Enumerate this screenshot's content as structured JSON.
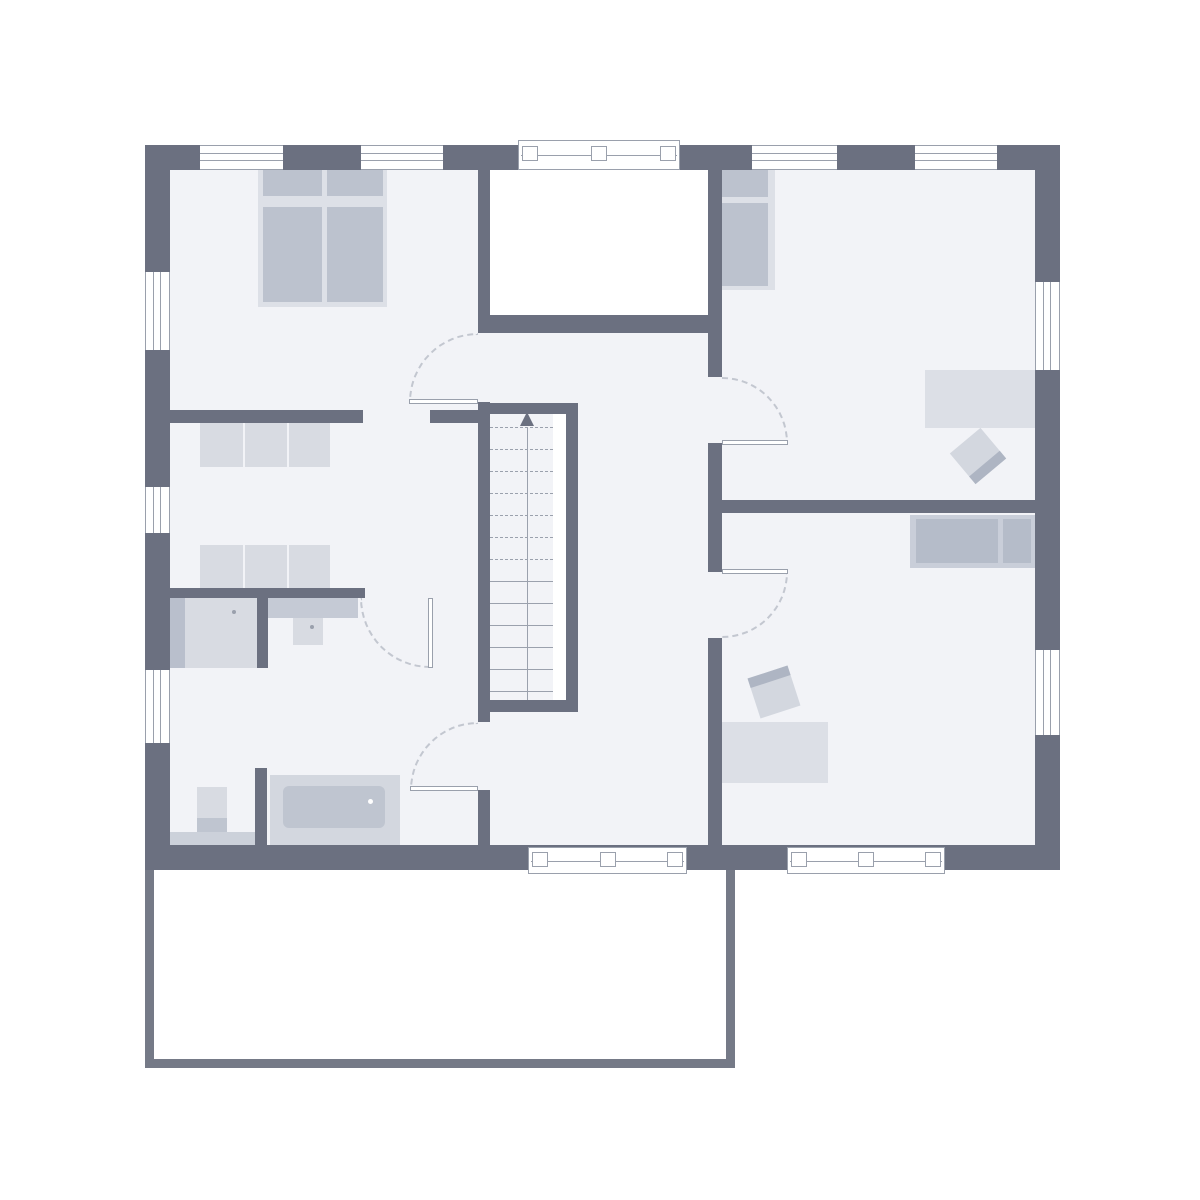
{
  "title": "residential-upper-floor-plan",
  "canvas": {
    "width": 1200,
    "height": 1200
  },
  "colors": {
    "wall": "#6b7080",
    "floor": "#f2f3f7",
    "frame": "#9aa0ac",
    "arc": "#c3c7d0",
    "tread": "#9ba1ad",
    "balcony": "#757a87",
    "furniture_light": "#dde0e7",
    "furniture_mid": "#bcc2ce",
    "white": "#ffffff"
  },
  "rooms": [
    {
      "name": "room-bedroom",
      "x": 170,
      "y": 170,
      "w": 308,
      "h": 240
    },
    {
      "name": "room-dressing",
      "x": 170,
      "y": 423,
      "w": 308,
      "h": 165
    },
    {
      "name": "room-bathroom",
      "x": 170,
      "y": 598,
      "w": 308,
      "h": 247
    },
    {
      "name": "room-hallway",
      "x": 490,
      "y": 333,
      "w": 218,
      "h": 512
    },
    {
      "name": "room-staircase",
      "x": 490,
      "y": 403,
      "w": 88,
      "h": 309
    },
    {
      "name": "room-void",
      "x": 490,
      "y": 170,
      "w": 218,
      "h": 145
    },
    {
      "name": "room-child-1",
      "x": 722,
      "y": 170,
      "w": 313,
      "h": 330
    },
    {
      "name": "room-child-2",
      "x": 722,
      "y": 513,
      "w": 313,
      "h": 332
    },
    {
      "name": "room-balcony",
      "x": 154,
      "y": 870,
      "w": 572,
      "h": 189
    }
  ],
  "elements": [
    {
      "name": "floor-area",
      "type": "fill",
      "x": 170,
      "y": 170,
      "w": 865,
      "h": 675
    },
    {
      "name": "void-open-space",
      "type": "voidarea",
      "x": 490,
      "y": 170,
      "w": 218,
      "h": 145
    },
    {
      "name": "stair-side-gap",
      "type": "voidarea",
      "x": 553,
      "y": 414,
      "w": 13,
      "h": 286
    },
    {
      "name": "double-bed-frame",
      "type": "furn",
      "x": 258,
      "y": 165,
      "w": 129,
      "h": 142,
      "color": "#dde0e7"
    },
    {
      "name": "double-bed-pillow-left",
      "type": "furn",
      "x": 263,
      "y": 169,
      "w": 59,
      "h": 27,
      "color": "#bcc2ce"
    },
    {
      "name": "double-bed-pillow-right",
      "type": "furn",
      "x": 327,
      "y": 169,
      "w": 56,
      "h": 27,
      "color": "#bcc2ce"
    },
    {
      "name": "double-bed-mattress-left",
      "type": "furn",
      "x": 263,
      "y": 207,
      "w": 59,
      "h": 95,
      "color": "#bcc2ce"
    },
    {
      "name": "double-bed-mattress-right",
      "type": "furn",
      "x": 327,
      "y": 207,
      "w": 56,
      "h": 95,
      "color": "#bcc2ce"
    },
    {
      "name": "wardrobe-row-1",
      "type": "furn",
      "x": 200,
      "y": 423,
      "w": 130,
      "h": 44,
      "color": "#d8dbe2"
    },
    {
      "name": "wardrobe-divider",
      "type": "furn",
      "x": 243,
      "y": 423,
      "w": 2,
      "h": 44,
      "color": "#f2f3f7"
    },
    {
      "name": "wardrobe-divider",
      "type": "furn",
      "x": 287,
      "y": 423,
      "w": 2,
      "h": 44,
      "color": "#f2f3f7"
    },
    {
      "name": "wardrobe-row-2",
      "type": "furn",
      "x": 200,
      "y": 545,
      "w": 130,
      "h": 43,
      "color": "#d8dbe2"
    },
    {
      "name": "wardrobe-divider",
      "type": "furn",
      "x": 243,
      "y": 545,
      "w": 2,
      "h": 43,
      "color": "#f2f3f7"
    },
    {
      "name": "wardrobe-divider",
      "type": "furn",
      "x": 287,
      "y": 545,
      "w": 2,
      "h": 43,
      "color": "#f2f3f7"
    },
    {
      "name": "shower",
      "type": "furn",
      "x": 163,
      "y": 598,
      "w": 94,
      "h": 70,
      "color": "#d8dbe2"
    },
    {
      "name": "shower-side-strip",
      "type": "furn",
      "x": 163,
      "y": 598,
      "w": 22,
      "h": 70,
      "color": "#b9bfcc"
    },
    {
      "name": "shower-drain-dot",
      "type": "furn dot",
      "x": 232,
      "y": 610,
      "w": 4,
      "h": 4,
      "color": "#9aa0ac"
    },
    {
      "name": "vanity-counter",
      "type": "furn",
      "x": 268,
      "y": 598,
      "w": 90,
      "h": 20,
      "color": "#c5cad5"
    },
    {
      "name": "washbasin",
      "type": "furn",
      "x": 293,
      "y": 618,
      "w": 30,
      "h": 27,
      "color": "#d8dbe2"
    },
    {
      "name": "washbasin-dot",
      "type": "furn dot",
      "x": 310,
      "y": 625,
      "w": 4,
      "h": 4,
      "color": "#9aa0ac"
    },
    {
      "name": "toilet-tank",
      "type": "furn",
      "x": 197,
      "y": 787,
      "w": 30,
      "h": 33,
      "color": "#d8dbe2"
    },
    {
      "name": "toilet-bowl",
      "type": "furn",
      "x": 197,
      "y": 818,
      "w": 30,
      "h": 15,
      "color": "#bfc5d0"
    },
    {
      "name": "bath-lower-counter",
      "type": "furn",
      "x": 170,
      "y": 832,
      "w": 85,
      "h": 13,
      "color": "#ccd1da"
    },
    {
      "name": "bathtub",
      "type": "furn",
      "x": 270,
      "y": 775,
      "w": 130,
      "h": 70,
      "color": "#d3d7df"
    },
    {
      "name": "bathtub-inner",
      "type": "furn rounded",
      "x": 283,
      "y": 786,
      "w": 102,
      "h": 42,
      "color": "#bfc5d0"
    },
    {
      "name": "bathtub-drain-dot",
      "type": "furn dot",
      "x": 368,
      "y": 799,
      "w": 5,
      "h": 5,
      "color": "#ffffff"
    },
    {
      "name": "child1-bed-frame",
      "type": "furn",
      "x": 718,
      "y": 165,
      "w": 57,
      "h": 125,
      "color": "#dde0e7"
    },
    {
      "name": "child1-bed-pillow",
      "type": "furn",
      "x": 722,
      "y": 169,
      "w": 46,
      "h": 28,
      "color": "#bcc2ce"
    },
    {
      "name": "child1-bed-mattress",
      "type": "furn",
      "x": 722,
      "y": 203,
      "w": 46,
      "h": 83,
      "color": "#bcc2ce"
    },
    {
      "name": "child1-desk",
      "type": "furn",
      "x": 925,
      "y": 370,
      "w": 110,
      "h": 58,
      "color": "#dcdfe6"
    },
    {
      "name": "child1-chair",
      "type": "chair strip-bottom",
      "x": 958,
      "y": 436,
      "w": 40,
      "h": 40,
      "rot": -40
    },
    {
      "name": "child2-bed-frame",
      "type": "furn",
      "x": 910,
      "y": 515,
      "w": 125,
      "h": 53,
      "color": "#c9ced9"
    },
    {
      "name": "child2-bed-mattress",
      "type": "furn",
      "x": 916,
      "y": 519,
      "w": 82,
      "h": 44,
      "color": "#b5bcc9"
    },
    {
      "name": "child2-bed-pillow",
      "type": "furn",
      "x": 1003,
      "y": 519,
      "w": 28,
      "h": 44,
      "color": "#b5bcc9"
    },
    {
      "name": "child2-desk",
      "type": "furn",
      "x": 720,
      "y": 722,
      "w": 108,
      "h": 61,
      "color": "#dcdfe6"
    },
    {
      "name": "child2-chair",
      "type": "chair strip-top",
      "x": 753,
      "y": 671,
      "w": 42,
      "h": 42,
      "rot": -18
    },
    {
      "name": "stair-top-wall",
      "type": "wall",
      "x": 490,
      "y": 403,
      "w": 88,
      "h": 11
    },
    {
      "name": "stair-rail-wall",
      "type": "wall",
      "x": 566,
      "y": 403,
      "w": 12,
      "h": 309
    },
    {
      "name": "stair-bottom-wall",
      "type": "wall",
      "x": 490,
      "y": 700,
      "w": 88,
      "h": 12
    },
    {
      "name": "stair-tread",
      "type": "tread-d",
      "x": 490,
      "y": 427,
      "w": 63,
      "h": 1
    },
    {
      "name": "stair-tread",
      "type": "tread-d",
      "x": 490,
      "y": 449,
      "w": 63,
      "h": 1
    },
    {
      "name": "stair-tread",
      "type": "tread-d",
      "x": 490,
      "y": 471,
      "w": 63,
      "h": 1
    },
    {
      "name": "stair-tread",
      "type": "tread-d",
      "x": 490,
      "y": 493,
      "w": 63,
      "h": 1
    },
    {
      "name": "stair-tread",
      "type": "tread-d",
      "x": 490,
      "y": 515,
      "w": 63,
      "h": 1
    },
    {
      "name": "stair-tread",
      "type": "tread-d",
      "x": 490,
      "y": 537,
      "w": 63,
      "h": 1
    },
    {
      "name": "stair-tread",
      "type": "tread-d",
      "x": 490,
      "y": 559,
      "w": 63,
      "h": 1
    },
    {
      "name": "stair-tread",
      "type": "tread-s",
      "x": 490,
      "y": 581,
      "w": 63,
      "h": 1
    },
    {
      "name": "stair-tread",
      "type": "tread-s",
      "x": 490,
      "y": 603,
      "w": 63,
      "h": 1
    },
    {
      "name": "stair-tread",
      "type": "tread-s",
      "x": 490,
      "y": 625,
      "w": 63,
      "h": 1
    },
    {
      "name": "stair-tread",
      "type": "tread-s",
      "x": 490,
      "y": 647,
      "w": 63,
      "h": 1
    },
    {
      "name": "stair-tread",
      "type": "tread-s",
      "x": 490,
      "y": 669,
      "w": 63,
      "h": 1
    },
    {
      "name": "stair-tread",
      "type": "tread-s",
      "x": 490,
      "y": 691,
      "w": 63,
      "h": 1
    },
    {
      "name": "stair-walk-line",
      "type": "walkline",
      "x": 527,
      "y": 427,
      "w": 1,
      "h": 273
    },
    {
      "name": "stair-direction-arrow",
      "type": "arrow-up",
      "x": 520,
      "y": 412,
      "w": 0,
      "h": 0
    },
    {
      "name": "wall-void-left-upper",
      "type": "wall",
      "x": 478,
      "y": 170,
      "w": 12,
      "h": 145
    },
    {
      "name": "wall-void-bottom",
      "type": "wall",
      "x": 478,
      "y": 315,
      "w": 230,
      "h": 18
    },
    {
      "name": "wall-stair-left",
      "type": "wall",
      "x": 478,
      "y": 402,
      "w": 12,
      "h": 320
    },
    {
      "name": "wall-below-bath-door",
      "type": "wall",
      "x": 478,
      "y": 790,
      "w": 12,
      "h": 55
    },
    {
      "name": "wall-children-west-a",
      "type": "wall",
      "x": 708,
      "y": 170,
      "w": 14,
      "h": 207
    },
    {
      "name": "wall-children-west-b",
      "type": "wall",
      "x": 708,
      "y": 443,
      "w": 14,
      "h": 129
    },
    {
      "name": "wall-children-west-c",
      "type": "wall",
      "x": 708,
      "y": 638,
      "w": 14,
      "h": 207
    },
    {
      "name": "wall-children-divider",
      "type": "wall",
      "x": 722,
      "y": 500,
      "w": 313,
      "h": 13
    },
    {
      "name": "wall-dressing-top-left",
      "type": "wall",
      "x": 170,
      "y": 410,
      "w": 193,
      "h": 13
    },
    {
      "name": "wall-dressing-top-right",
      "type": "wall",
      "x": 430,
      "y": 410,
      "w": 48,
      "h": 13
    },
    {
      "name": "wall-bath-top",
      "type": "wall",
      "x": 170,
      "y": 588,
      "w": 195,
      "h": 10
    },
    {
      "name": "wall-shower-partition",
      "type": "wall",
      "x": 257,
      "y": 588,
      "w": 11,
      "h": 80
    },
    {
      "name": "wall-tub-partition",
      "type": "wall",
      "x": 255,
      "y": 768,
      "w": 12,
      "h": 77
    },
    {
      "name": "outer-wall-top",
      "type": "wall",
      "x": 145,
      "y": 145,
      "w": 915,
      "h": 25
    },
    {
      "name": "outer-wall-bottom",
      "type": "wall",
      "x": 145,
      "y": 845,
      "w": 915,
      "h": 25
    },
    {
      "name": "outer-wall-left",
      "type": "wall",
      "x": 145,
      "y": 145,
      "w": 25,
      "h": 725
    },
    {
      "name": "outer-wall-right",
      "type": "wall",
      "x": 1035,
      "y": 145,
      "w": 25,
      "h": 725
    },
    {
      "name": "window-top-bedroom-1",
      "type": "window-h",
      "x": 200,
      "y": 145,
      "w": 83,
      "h": 25
    },
    {
      "name": "window-top-bedroom-2",
      "type": "window-h",
      "x": 361,
      "y": 145,
      "w": 82,
      "h": 25
    },
    {
      "name": "window-top-void",
      "type": "window-sq",
      "x": 518,
      "y": 140,
      "w": 162,
      "h": 30
    },
    {
      "name": "window-top-child1-1",
      "type": "window-h",
      "x": 752,
      "y": 145,
      "w": 85,
      "h": 25
    },
    {
      "name": "window-top-child1-2",
      "type": "window-h",
      "x": 915,
      "y": 145,
      "w": 82,
      "h": 25
    },
    {
      "name": "window-left-bedroom",
      "type": "window-v",
      "x": 145,
      "y": 272,
      "w": 25,
      "h": 78
    },
    {
      "name": "window-left-dressing",
      "type": "window-v",
      "x": 145,
      "y": 487,
      "w": 25,
      "h": 46
    },
    {
      "name": "window-left-bathroom",
      "type": "window-v",
      "x": 145,
      "y": 670,
      "w": 25,
      "h": 73
    },
    {
      "name": "window-right-child1",
      "type": "window-v",
      "x": 1035,
      "y": 282,
      "w": 25,
      "h": 88
    },
    {
      "name": "window-right-child2",
      "type": "window-v",
      "x": 1035,
      "y": 650,
      "w": 25,
      "h": 85
    },
    {
      "name": "balcony-door-hall",
      "type": "window-sq",
      "x": 528,
      "y": 847,
      "w": 159,
      "h": 27
    },
    {
      "name": "balcony-door-child2",
      "type": "window-sq",
      "x": 787,
      "y": 847,
      "w": 158,
      "h": 27
    },
    {
      "name": "door-arc-child1",
      "type": "arc arc-tr",
      "x": 722,
      "y": 377,
      "w": 66,
      "h": 66
    },
    {
      "name": "door-leaf-child1",
      "type": "leaf",
      "x": 722,
      "y": 440,
      "w": 66,
      "h": 5
    },
    {
      "name": "door-arc-child2",
      "type": "arc arc-br",
      "x": 722,
      "y": 572,
      "w": 66,
      "h": 66
    },
    {
      "name": "door-leaf-child2",
      "type": "leaf",
      "x": 722,
      "y": 569,
      "w": 66,
      "h": 5
    },
    {
      "name": "door-arc-bedroom",
      "type": "arc arc-tl",
      "x": 409,
      "y": 333,
      "w": 69,
      "h": 69
    },
    {
      "name": "door-leaf-bedroom",
      "type": "leaf",
      "x": 409,
      "y": 399,
      "w": 69,
      "h": 5
    },
    {
      "name": "door-arc-dressing-bath",
      "type": "arc arc-bl",
      "x": 360,
      "y": 598,
      "w": 70,
      "h": 70
    },
    {
      "name": "door-leaf-dressing-bath",
      "type": "leaf",
      "x": 428,
      "y": 598,
      "w": 5,
      "h": 70
    },
    {
      "name": "door-arc-hall-bath",
      "type": "arc arc-tl",
      "x": 410,
      "y": 722,
      "w": 68,
      "h": 68
    },
    {
      "name": "door-leaf-hall-bath",
      "type": "leaf",
      "x": 410,
      "y": 786,
      "w": 68,
      "h": 5
    },
    {
      "name": "balcony-edge-left",
      "type": "balcony-edge",
      "x": 145,
      "y": 870,
      "w": 9,
      "h": 198
    },
    {
      "name": "balcony-edge-bottom",
      "type": "balcony-edge",
      "x": 145,
      "y": 1059,
      "w": 590,
      "h": 9
    },
    {
      "name": "balcony-edge-right",
      "type": "balcony-edge",
      "x": 726,
      "y": 870,
      "w": 9,
      "h": 198
    }
  ]
}
